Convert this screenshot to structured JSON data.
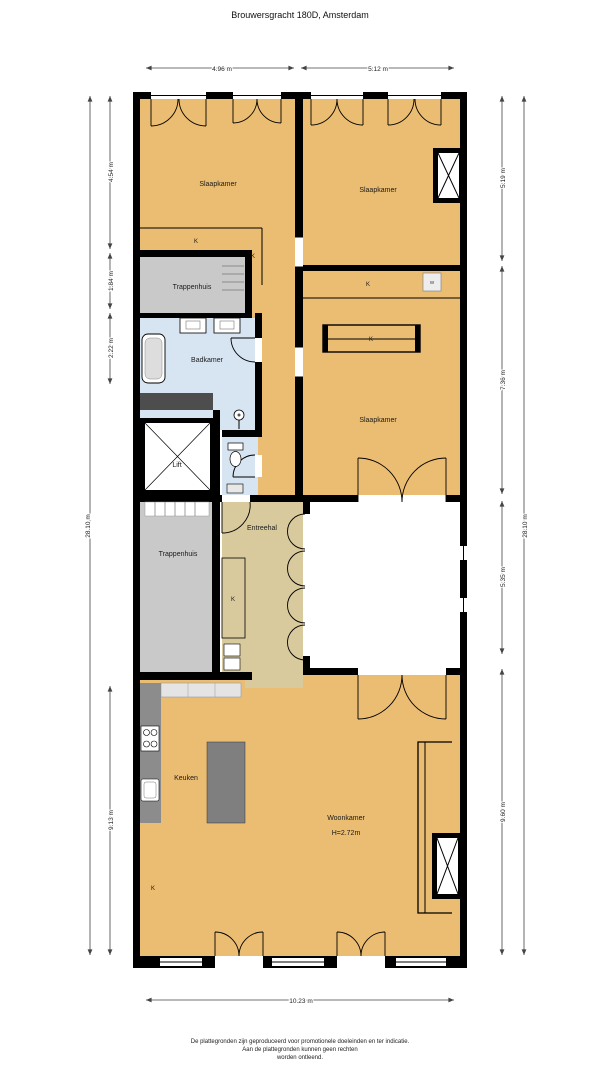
{
  "title": "Brouwersgracht 180D, Amsterdam",
  "plan": {
    "rooms": {
      "slaapkamer1": "Slaapkamer",
      "slaapkamer2": "Slaapkamer",
      "slaapkamer3": "Slaapkamer",
      "trappenhuis1": "Trappenhuis",
      "trappenhuis2": "Trappenhuis",
      "badkamer": "Badkamer",
      "lift": "Lift",
      "entreehal": "Entreehal",
      "keuken": "Keuken",
      "woonkamer": "Woonkamer",
      "woonkamer_height": "H=2.72m",
      "closet": "K",
      "washer": "W"
    },
    "dimensions": {
      "top": [
        "4.96 m",
        "5.12 m"
      ],
      "bottom": "10.23 m",
      "left_total": "28.10 m",
      "right_total": "28.10 m",
      "left": [
        "4.54 m",
        "1.84 m",
        "2.22 m",
        "9.13 m"
      ],
      "right": [
        "5.19 m",
        "7.36 m",
        "5.35 m",
        "9.60 m"
      ]
    },
    "colors": {
      "room": "#EBBD72",
      "hall": "#D9CA9E",
      "bath": "#D7E4F1",
      "stairwell": "#C9C9C9",
      "wall": "#000000",
      "counter": "#8C8C8C",
      "island": "#7F7F7F"
    }
  },
  "footer": {
    "line1": "De plattegronden zijn geproduceerd voor promotionele doeleinden en ter indicatie.",
    "line2": "Aan de plattegronden kunnen geen rechten",
    "line3": "worden ontleend."
  }
}
